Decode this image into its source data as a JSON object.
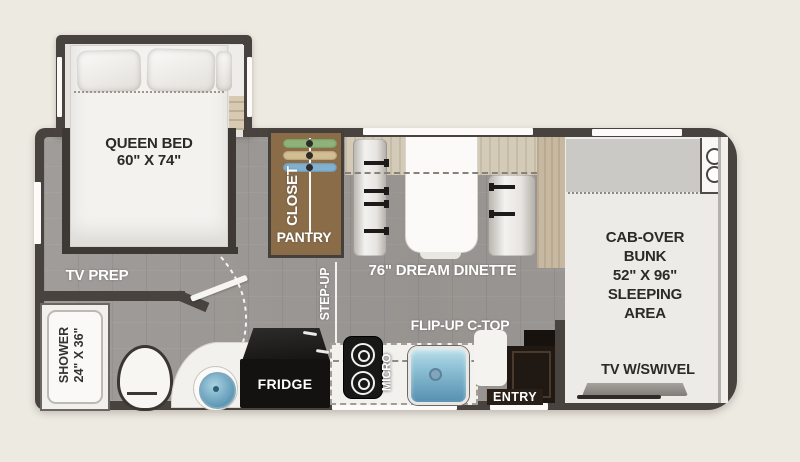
{
  "colors": {
    "background": "#EDEAE2",
    "wall": "#49433F",
    "floor": "#9A9693",
    "closet_wood": "#8A6C49",
    "sink_blue": "#6FAECB",
    "fridge_black": "#131211"
  },
  "bedroom": {
    "bed_line1": "QUEEN BED",
    "bed_line2": "60\" X 74\"",
    "tv_prep": "TV PREP"
  },
  "storage": {
    "closet": "CLOSET",
    "pantry": "PANTRY"
  },
  "hall": {
    "step_up": "STEP-UP"
  },
  "dinette": {
    "label": "76\" DREAM DINETTE"
  },
  "bunk": {
    "lines": [
      "CAB-OVER",
      "BUNK",
      "52\" X 96\"",
      "SLEEPING",
      "AREA"
    ],
    "tv": "TV W/SWIVEL"
  },
  "bathroom": {
    "shower_line1": "SHOWER",
    "shower_line2": "24\" X 36\""
  },
  "kitchen": {
    "fridge": "FRIDGE",
    "micro": "MICRO",
    "flip_up": "FLIP-UP C-TOP",
    "entry": "ENTRY"
  }
}
